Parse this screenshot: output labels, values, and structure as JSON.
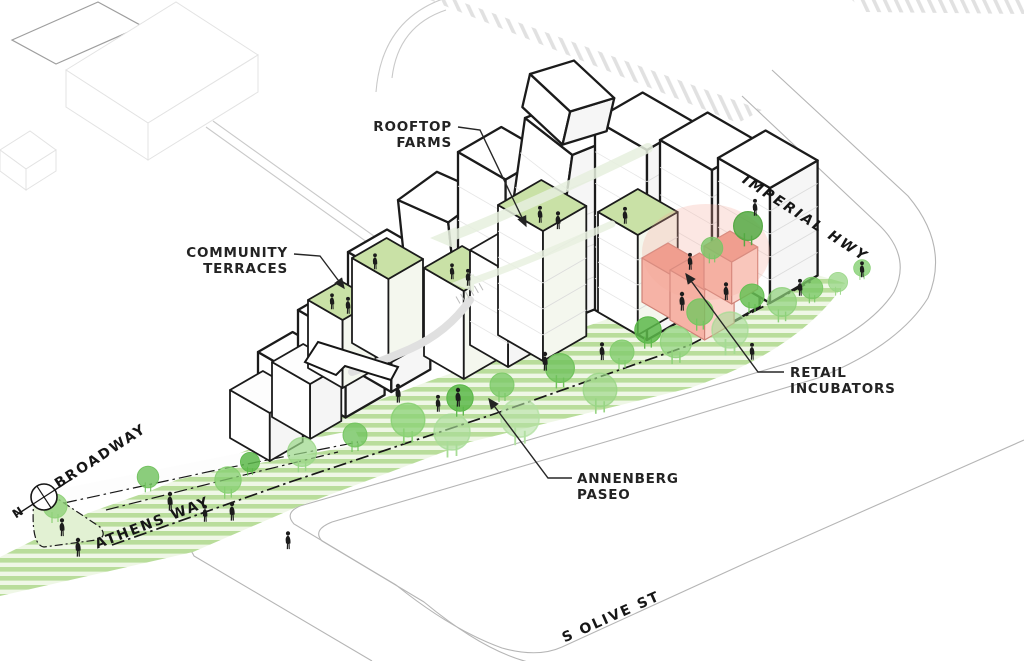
{
  "title": "Mixed-use development axonometric site diagram",
  "annotations": {
    "rooftop_farms": {
      "line1": "ROOFTOP",
      "line2": "FARMS"
    },
    "community_terraces": {
      "line1": "COMMUNITY",
      "line2": "TERRACES"
    },
    "retail_incubators": {
      "line1": "RETAIL",
      "line2": "INCUBATORS"
    },
    "annenberg_paseo": {
      "line1": "ANNENBERG",
      "line2": "PASEO"
    }
  },
  "streets": {
    "imperial": "IMPERIAL HWY",
    "broadway": "S BROADWAY",
    "athens": "ATHENS WAY",
    "olive": "S OLIVE ST"
  },
  "compass": {
    "north_label": "N"
  },
  "colors": {
    "paseo_stripe": "#b9dd9b",
    "paseo_stripe_light": "#eff7e6",
    "rooftop_green": "#c9e1a6",
    "tree_greens": [
      "#5cb84a",
      "#74c660",
      "#8ed17a",
      "#a8dc97",
      "#d8eecb"
    ],
    "retail_pink": "#f6b3a6",
    "retail_pink_roof": "#ef9a8b",
    "outline_ink": "#1b1b1b",
    "context_gray": "#c9c9c9",
    "figure_black": "#1c1c1c"
  }
}
